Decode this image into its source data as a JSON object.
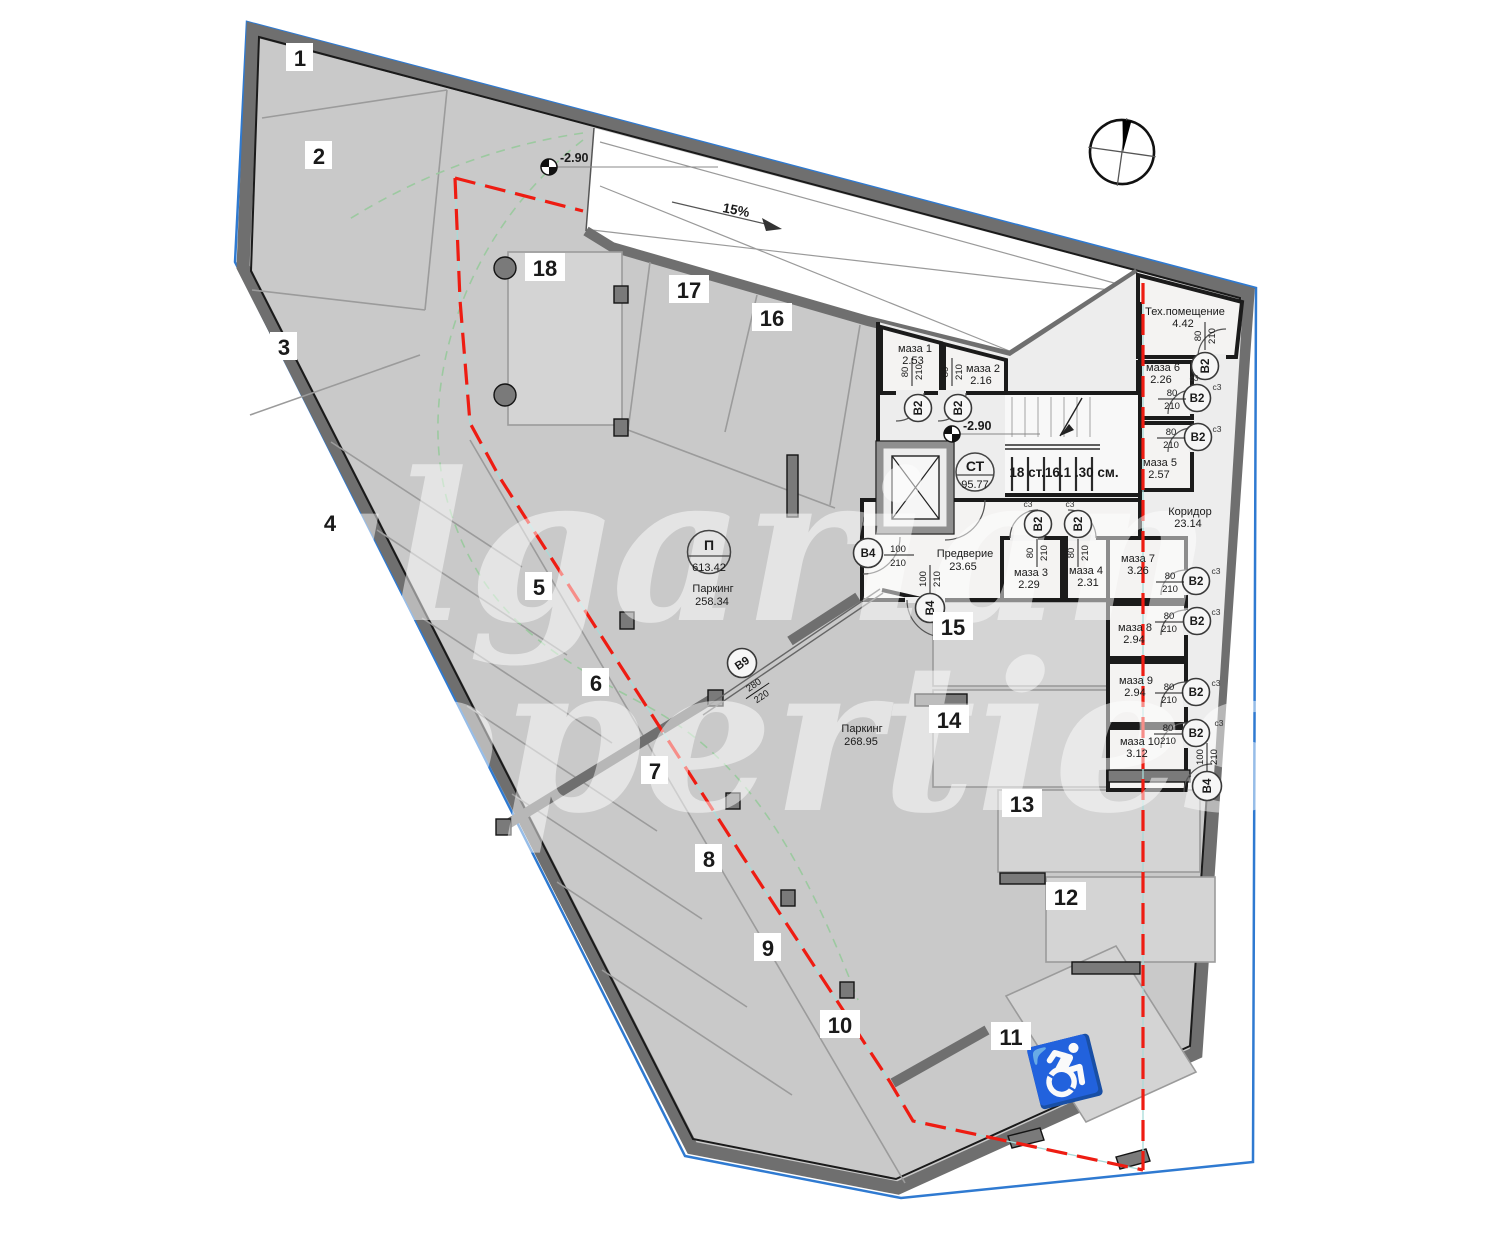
{
  "plan": {
    "watermark_line1": "Bulgarian",
    "watermark_line2": "Properties",
    "ramp_slope": "15%",
    "level_ramp": "-2.90",
    "level_stair": "-2.90",
    "stair_note": "18 ст.16.1 .30 см."
  },
  "symbols": {
    "stair_circle": {
      "code": "СТ",
      "area": "95.77"
    },
    "parking_circle": {
      "code": "П",
      "area": "613.42"
    }
  },
  "zones": {
    "parking_west": {
      "name": "Паркинг",
      "area": "258.34"
    },
    "parking_south": {
      "name": "Паркинг",
      "area": "268.95"
    }
  },
  "rooms": {
    "maza1": {
      "name": "маза 1",
      "area": "2.53"
    },
    "maza2": {
      "name": "маза 2",
      "area": "2.16"
    },
    "maza3": {
      "name": "маза 3",
      "area": "2.29"
    },
    "maza4": {
      "name": "маза 4",
      "area": "2.31"
    },
    "maza5": {
      "name": "маза 5",
      "area": "2.57"
    },
    "maza6": {
      "name": "маза 6",
      "area": "2.26"
    },
    "maza7": {
      "name": "маза 7",
      "area": "3.26"
    },
    "maza8": {
      "name": "маза 8",
      "area": "2.94"
    },
    "maza9": {
      "name": "маза 9",
      "area": "2.94"
    },
    "maza10": {
      "name": "маза 10",
      "area": "3.12"
    },
    "tech": {
      "name": "Тех.помещение",
      "area": "4.42"
    },
    "corridor": {
      "name": "Коридор",
      "area": "23.14"
    },
    "vestibule": {
      "name": "Предверие",
      "area": "23.65"
    }
  },
  "doors": {
    "b2": {
      "label": "В2",
      "width": "80",
      "height": "210"
    },
    "b4": {
      "label": "В4",
      "width": "100",
      "height": "210"
    },
    "b9": {
      "label": "В9",
      "width": "280",
      "height": "220"
    },
    "tag": "с3"
  },
  "parking_stalls": [
    "1",
    "2",
    "3",
    "4",
    "5",
    "6",
    "7",
    "8",
    "9",
    "10",
    "11",
    "12",
    "13",
    "14",
    "15",
    "16",
    "17",
    "18"
  ],
  "icons": {
    "handicap": "♿"
  },
  "colors": {
    "boundary_line": "#2f7ad1",
    "building_outline_red": "#ee1c12",
    "turning_path_green": "#9cc9a0",
    "site_wall": "#6f6f6f",
    "floor": "#c9c9c9",
    "core_floor": "#ededed",
    "room_fill": "#f4f3f2"
  }
}
